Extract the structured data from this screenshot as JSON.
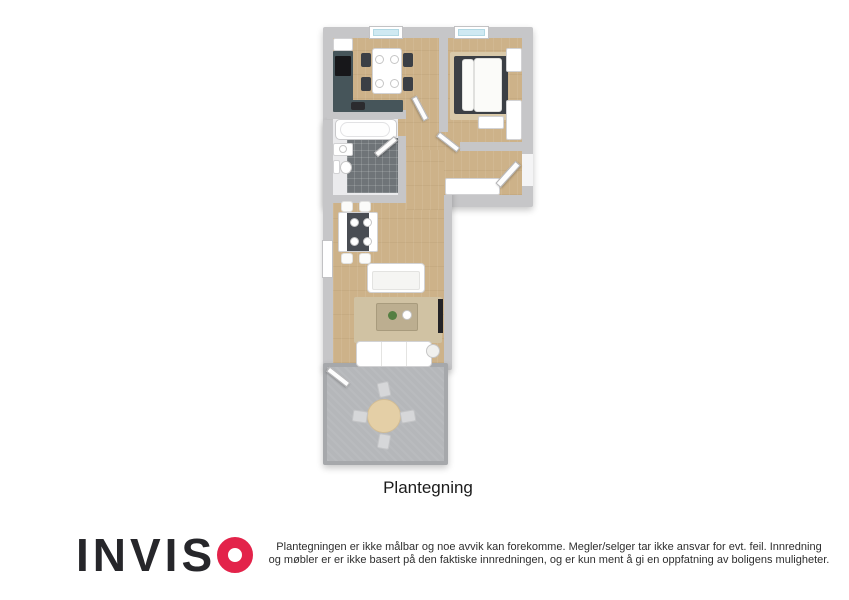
{
  "floorplan": {
    "caption": "Plantegning",
    "rooms": [
      "kitchen",
      "bedroom",
      "bathroom",
      "hallway",
      "living-room",
      "terrace"
    ],
    "palette": {
      "wall": "#c6c6c8",
      "wood_floor": "#cdb289",
      "bathroom_tile": "#6f7478",
      "terrace_floor": "#b5b7ba",
      "rug": "#d9c9a9",
      "window_glass": "#cfe9f2",
      "dark_furniture": "#3b3f45",
      "kitchen_counter": "#46555a"
    }
  },
  "footer": {
    "logo": {
      "letters": "INVIS",
      "text_color": "#26262a",
      "o_color": "#e3234a"
    },
    "disclaimer": {
      "line1": "Plantegningen er ikke målbar og noe avvik kan forekomme. Megler/selger tar ikke ansvar for evt. feil. Innredning",
      "line2": "og møbler er er ikke basert på den faktiske innredningen, og er kun ment å gi en oppfatning av boligens muligheter."
    }
  }
}
